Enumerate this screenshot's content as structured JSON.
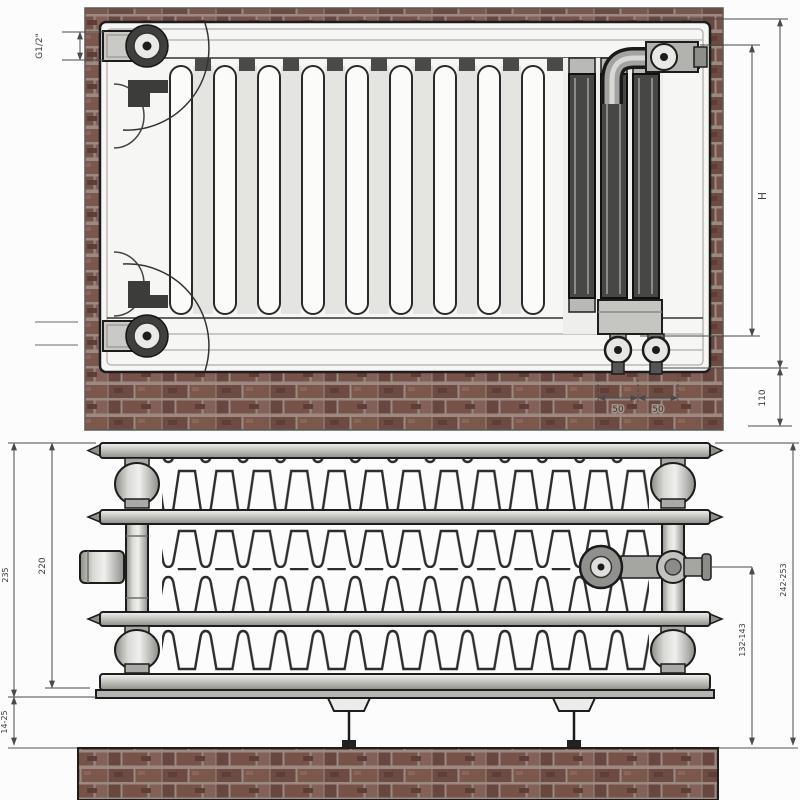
{
  "drawing": {
    "type": "radiator technical installation drawing, front view over brick wall and plan/top section view",
    "front": {
      "dims": {
        "thread": "G1/2\"",
        "height": "H",
        "clearance": "110",
        "spacing_a": "50",
        "spacing_b": "50"
      }
    },
    "plan": {
      "dims": {
        "depth_body": "220",
        "depth_with_brackets": "235",
        "foot_adjust": "14-25",
        "valve_axis_height": "132-143",
        "overall_height": "242-253"
      }
    },
    "colors": {
      "brick": "#6e4b42",
      "mortar": "#9a8a82",
      "metal_dark": "#474745",
      "metal_light": "#d9d9d5",
      "outline": "#1d1d1d",
      "dimension_line": "#4a4a4a"
    }
  }
}
